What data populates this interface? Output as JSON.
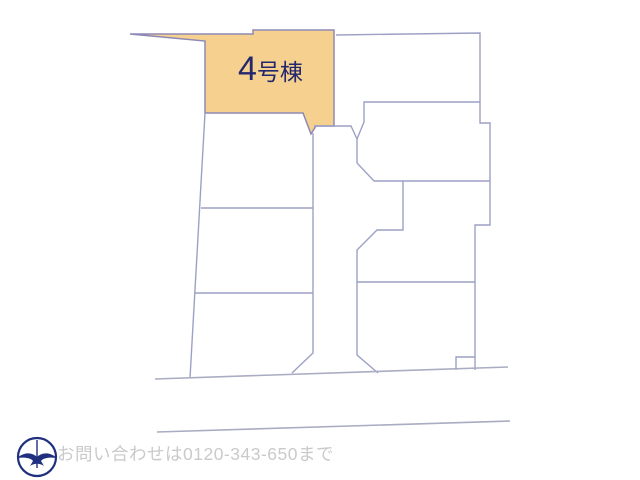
{
  "site_plan": {
    "background": "#ffffff",
    "line_color": "#9CA1C4",
    "street_color": "#A9ACC2",
    "highlight": {
      "label": "4号棟",
      "label_big": "4",
      "label_small": "号棟",
      "fill": "#F6D08E",
      "stroke": "#8D89B6",
      "label_color": "#23276D",
      "polygon": [
        [
          130,
          34
        ],
        [
          253,
          34
        ],
        [
          253,
          30
        ],
        [
          334,
          30
        ],
        [
          334,
          126
        ],
        [
          316,
          126
        ],
        [
          311,
          134
        ],
        [
          303,
          113
        ],
        [
          205,
          113
        ],
        [
          205,
          41
        ]
      ]
    },
    "boundaries": [
      [
        [
          336,
          35
        ],
        [
          480,
          33
        ],
        [
          480,
          123
        ],
        [
          490,
          123
        ],
        [
          490,
          225
        ],
        [
          475,
          225
        ],
        [
          475,
          370
        ]
      ],
      [
        [
          475,
          357
        ],
        [
          456,
          357
        ],
        [
          456,
          370
        ]
      ],
      [
        [
          480,
          102
        ],
        [
          364,
          102
        ],
        [
          364,
          122
        ],
        [
          357,
          139
        ],
        [
          357,
          163
        ],
        [
          374,
          181
        ]
      ],
      [
        [
          314,
          126
        ],
        [
          351,
          126
        ],
        [
          357,
          139
        ]
      ],
      [
        [
          374,
          181
        ],
        [
          490,
          181
        ]
      ],
      [
        [
          403,
          181
        ],
        [
          403,
          230
        ],
        [
          377,
          230
        ],
        [
          357,
          250
        ],
        [
          357,
          355
        ],
        [
          378,
          373
        ]
      ],
      [
        [
          357,
          282
        ],
        [
          475,
          282
        ]
      ],
      [
        [
          205,
          113
        ],
        [
          190,
          378
        ]
      ],
      [
        [
          201,
          208
        ],
        [
          313,
          208
        ]
      ],
      [
        [
          195,
          293
        ],
        [
          313,
          293
        ]
      ],
      [
        [
          313,
          133
        ],
        [
          313,
          353
        ],
        [
          292,
          373
        ]
      ]
    ],
    "streets": [
      [
        [
          155,
          379
        ],
        [
          508,
          367
        ]
      ],
      [
        [
          157,
          432
        ],
        [
          510,
          421
        ]
      ]
    ]
  },
  "footer": {
    "contact_text": "お問い合わせは0120-343-650まで",
    "text_color": "#C9CACB",
    "compass": {
      "label": "N",
      "color": "#20307E"
    }
  }
}
